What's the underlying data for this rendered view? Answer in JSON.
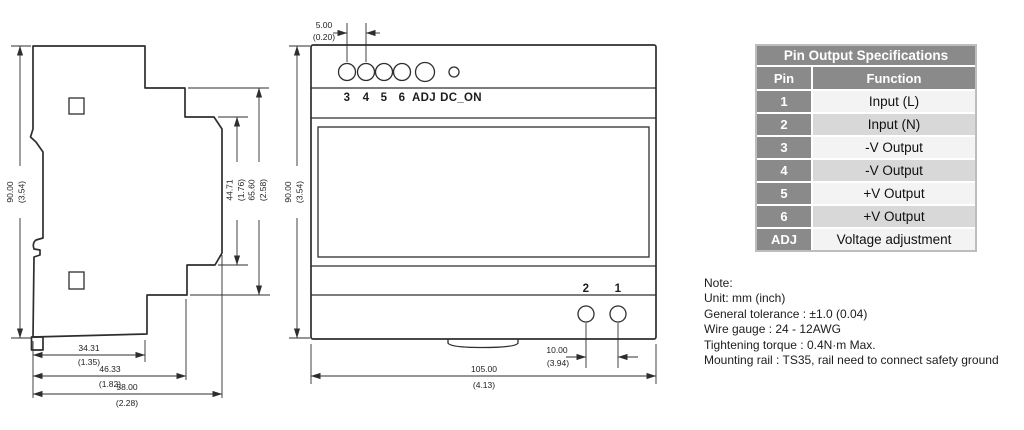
{
  "side_view": {
    "dims": {
      "height": {
        "mm": "90.00",
        "in": "(3.54)"
      },
      "step1": {
        "mm": "44.71",
        "in": "(1.76)"
      },
      "step2": {
        "mm": "65.60",
        "in": "(2.58)"
      },
      "depth1": {
        "mm": "34.31",
        "in": "(1.35)"
      },
      "depth2": {
        "mm": "46.33",
        "in": "(1.82)"
      },
      "depth3": {
        "mm": "58.00",
        "in": "(2.28)"
      }
    }
  },
  "front_view": {
    "dims": {
      "pitch": {
        "mm": "5.00",
        "in": "(0.20)"
      },
      "height": {
        "mm": "90.00",
        "in": "(3.54)"
      },
      "width": {
        "mm": "105.00",
        "in": "(4.13)"
      },
      "input_pitch": {
        "mm": "10.00",
        "in": "(3.94)"
      }
    },
    "output_terminals": [
      "3",
      "4",
      "5",
      "6",
      "ADJ",
      "DC_ON"
    ],
    "input_terminals": [
      "2",
      "1"
    ]
  },
  "table": {
    "title": "Pin Output Specifications",
    "columns": [
      "Pin",
      "Function"
    ],
    "rows": [
      {
        "pin": "1",
        "fn": "Input (L)"
      },
      {
        "pin": "2",
        "fn": "Input (N)"
      },
      {
        "pin": "3",
        "fn": "-V Output"
      },
      {
        "pin": "4",
        "fn": "-V Output"
      },
      {
        "pin": "5",
        "fn": "+V Output"
      },
      {
        "pin": "6",
        "fn": "+V Output"
      },
      {
        "pin": "ADJ",
        "fn": "Voltage adjustment"
      }
    ]
  },
  "notes": {
    "lines": [
      "Note:",
      "Unit: mm (inch)",
      "General tolerance : ±1.0 (0.04)",
      "Wire gauge : 24 - 12AWG",
      "Tightening torque : 0.4N·m Max.",
      "Mounting rail : TS35, rail need to connect safety ground"
    ]
  },
  "colors": {
    "line": "#2e2e2e",
    "table_header_bg": "#8a8a8a",
    "table_row_light": "#f3f3f3",
    "table_row_dark": "#d8d8d8",
    "table_border": "#bdbdbd"
  }
}
